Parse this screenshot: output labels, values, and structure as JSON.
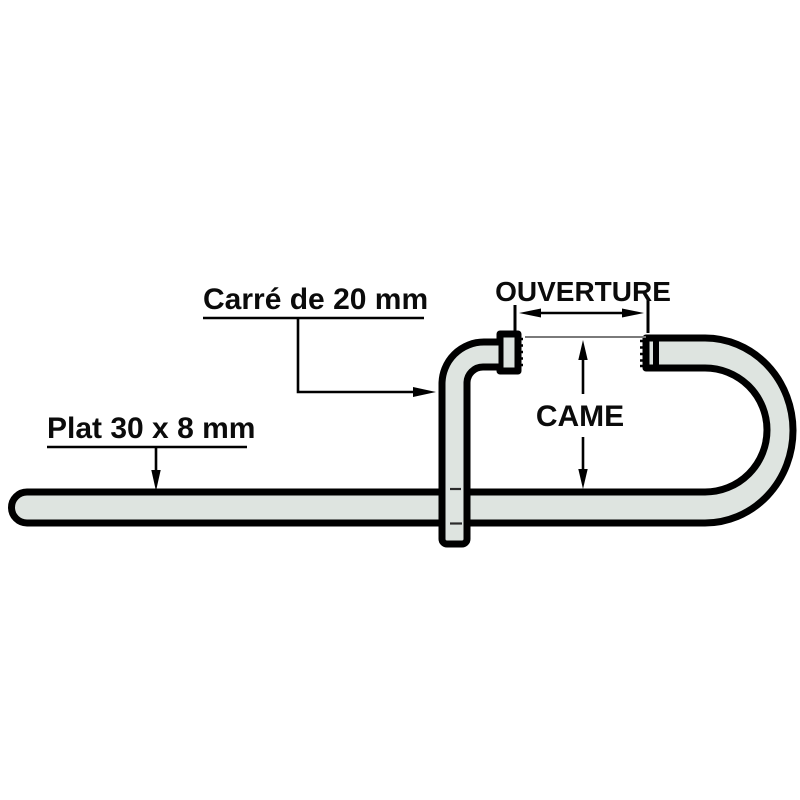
{
  "diagram": {
    "labels": {
      "carre": "Carré de 20 mm",
      "plat": "Plat 30 x 8 mm",
      "ouverture": "OUVERTURE",
      "came": "CAME"
    },
    "colors": {
      "metal_fill": "#dee4e0",
      "outline": "#000000",
      "extension_line": "#7a7a7a",
      "background": "#ffffff"
    }
  }
}
